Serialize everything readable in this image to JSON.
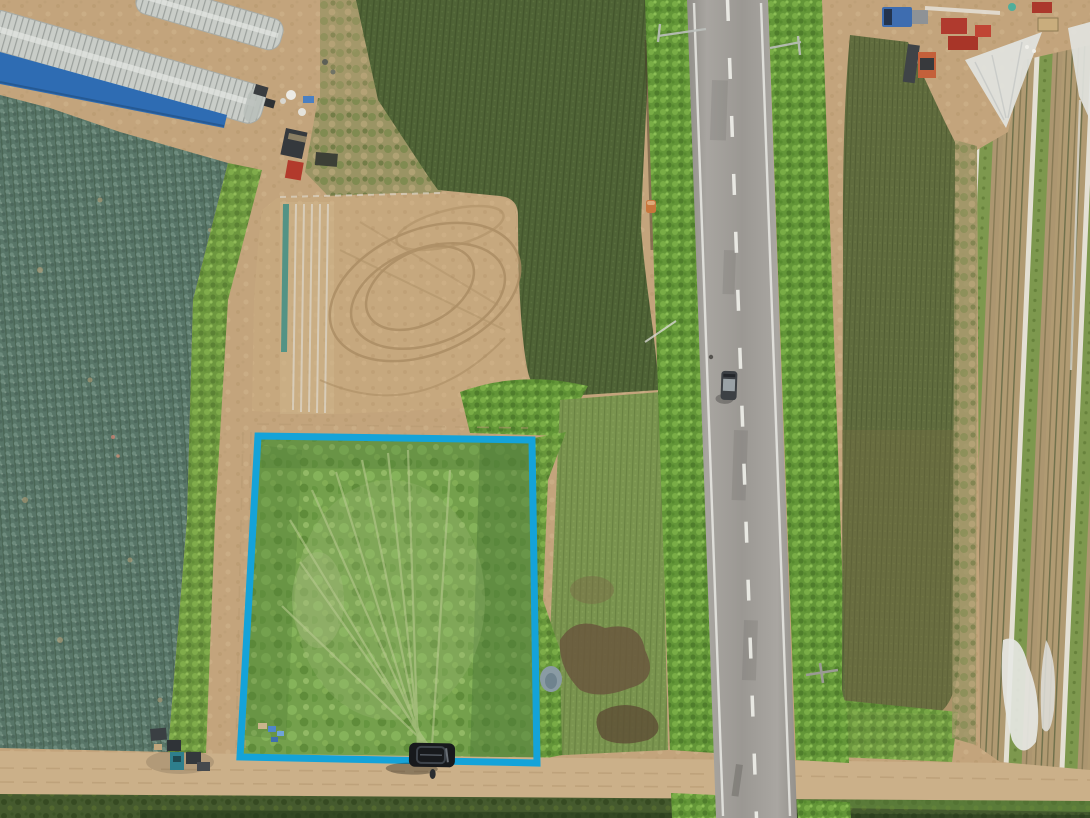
{
  "scene": {
    "kind": "aerial-drone-photograph",
    "subject": "farmland with a highlighted land parcel beside a rural road",
    "annotation": {
      "shape": "parcel-boundary-rectangle",
      "stroke_px": 7
    },
    "features": [
      "greenhouse-tunnels",
      "blue-tarp",
      "cabbage-field",
      "equipment-yard",
      "dark-crop-field",
      "tilled-field-with-tractor-tracks",
      "seed-row-covers",
      "highlighted-overgrown-parcel",
      "blue-crates",
      "mud-patches",
      "pond",
      "two-lane-road",
      "road-hedgerows",
      "van-driving",
      "parked-suv",
      "person",
      "tractor-cluster",
      "olive-crop-field",
      "netted-crop-rows",
      "white-row-covers",
      "farm-machinery",
      "dirt-road-intersection",
      "utility-pole"
    ],
    "vehicle_counts": {
      "van_on_road": 1,
      "parked_suv": 1,
      "yard_trucks": 2
    }
  },
  "colors": {
    "annotation_blue": "#14a3d9",
    "dirt_tan": "#c3a47c",
    "dirt_road": "#cbb089",
    "cabbage_teal": "#587668",
    "dark_field_green": "#4f6336",
    "tilled_tan": "#c6a87e",
    "parcel_green": "#74a04c",
    "hedge_green": "#639638",
    "mid_field_green": "#7a944f",
    "olive_field": "#606c3e",
    "asphalt": "#a2a09a",
    "road_marking": "#efefe9",
    "mud_brown": "#6a573d",
    "pond_gray": "#8a9ba4",
    "greenhouse_gray": "#c9cdc8",
    "tarp_blue": "#2e6cb3",
    "netting_white": "#e2e4e1",
    "grass_dark": "#455a2e",
    "van_gray": "#3c4044",
    "suv_black": "#17191c",
    "truck_blue": "#3e6db0",
    "machine_red": "#b03a2e",
    "tractor_orange": "#c4603a",
    "tractor_teal": "#2e7f8c"
  }
}
